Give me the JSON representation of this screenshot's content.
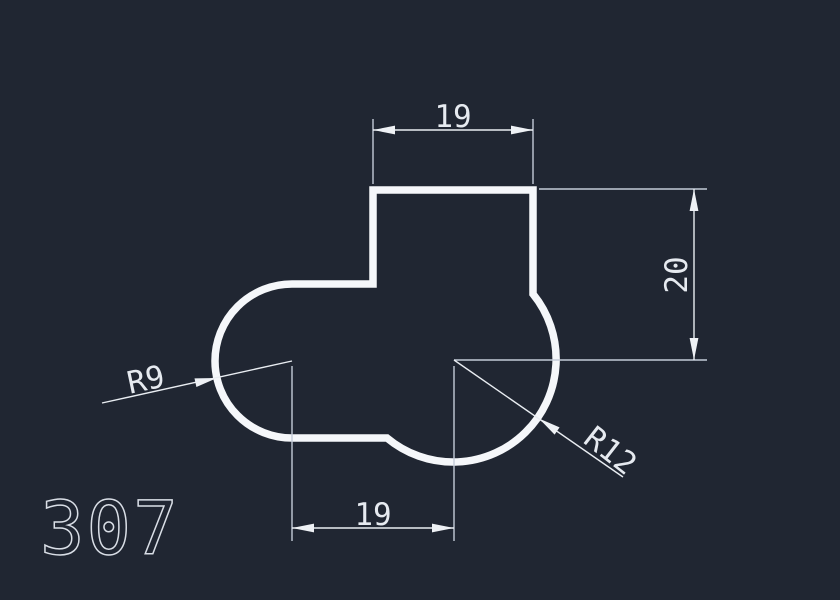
{
  "drawing": {
    "part_number": "307",
    "dimensions": {
      "top_width": {
        "value": "19"
      },
      "right_height": {
        "value": "20"
      },
      "bottom_width": {
        "value": "19"
      },
      "radius_left": {
        "value": "R9"
      },
      "radius_right": {
        "value": "R12"
      }
    },
    "colors": {
      "background": "#202632",
      "part_outline": "#f5f7fa",
      "dimension_lines": "#e9edf2",
      "extension_lines": "#c3cbd8",
      "text": "#e6eaf0"
    }
  }
}
